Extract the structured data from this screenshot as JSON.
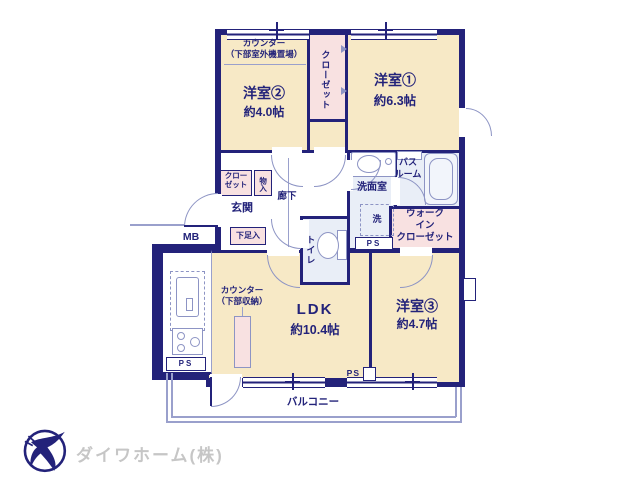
{
  "plan": {
    "rooms": {
      "western1": {
        "name": "洋室①",
        "size": "約6.3帖"
      },
      "western2": {
        "name": "洋室②",
        "size": "約4.0帖"
      },
      "western3": {
        "name": "洋室③",
        "size": "約4.7帖"
      },
      "ldk": {
        "name": "LDK",
        "size": "約10.4帖"
      }
    },
    "labels": {
      "counter_top_1": "カウンター",
      "counter_top_2": "（下部室外機置場）",
      "closet_vertical": "クローゼット",
      "closet_1": "クロー",
      "closet_2": "ゼット",
      "monoire": "物入",
      "genkan": "玄関",
      "shitasokuire": "下足入",
      "rouka": "廊下",
      "toilet": "トイレ",
      "senmenshitsu": "洗面室",
      "laundry": "洗",
      "bath_1": "バス",
      "bath_2": "ルーム",
      "wic_1": "ウォーク",
      "wic_2": "イン",
      "wic_3": "クローゼット",
      "mb": "MB",
      "ps": "PS",
      "counter_kitchen_1": "カウンター",
      "counter_kitchen_2": "（下部収納）",
      "balcony": "バルコニー"
    },
    "colors": {
      "wall": "#23227a",
      "room_fill": "#f7e9c6",
      "closet_fill": "#f8e1e1",
      "wet_area_fill": "#e9eef7",
      "fixture_line": "#8d94c4",
      "logo_text": "#c6c6c6"
    }
  },
  "footer": {
    "company": "ダイワホーム(株)"
  }
}
